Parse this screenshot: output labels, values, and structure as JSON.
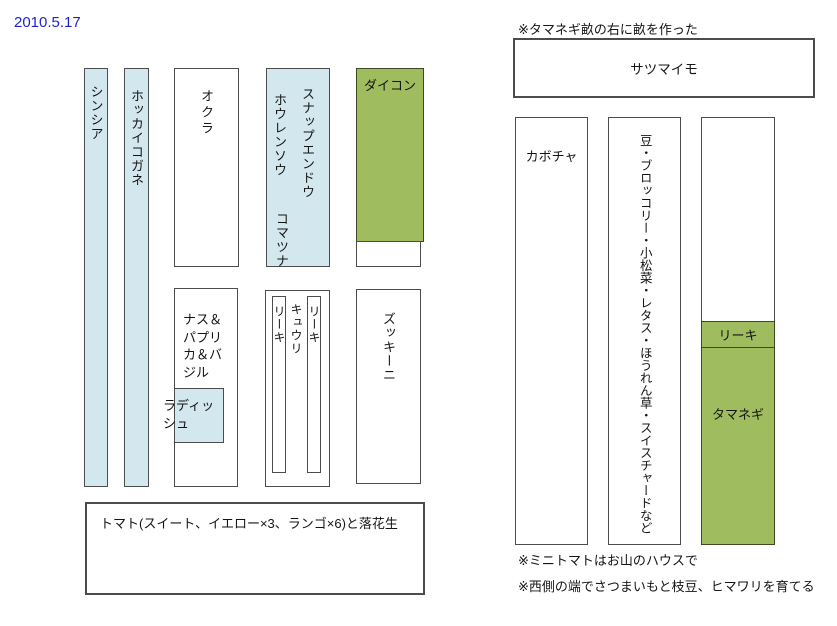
{
  "date": "2010.5.17",
  "colors": {
    "date_text": "#2222cc",
    "bed_lightblue": "#d3e7ee",
    "bed_green": "#9fbc5e",
    "border_dark": "#4c4c4c",
    "border_green": "#3e4a20"
  },
  "west_plot": {
    "shinshia": "シンシア",
    "hokkaikogane": "ホッカイコガネ",
    "okra": "オクラ",
    "snap_endou": "スナップエンドウ",
    "hourensou": "ホウレンソウ",
    "komatsuna": "コマツナ",
    "daikon": "ダイコン",
    "nasu_paprika_basil": "ナス＆パプリカ＆バジル",
    "radish": "ラディッシュ",
    "leek_left": "リーキ",
    "cucumber": "キュウリ",
    "leek_right": "リーキ",
    "zucchini": "ズッキーニ",
    "tomato": "トマト(スイート、イエロー×3、ランゴ×6)と落花生"
  },
  "east_plot": {
    "note_top": "※タマネギ畝の右に畝を作った",
    "satsumaimo": "サツマイモ",
    "kabocha": "カボチャ",
    "mixed_bed": "豆・ブロッコリー・小松菜・レタス・ほうれん草・スイスチャードなど",
    "leek": "リーキ",
    "tamanegi": "タマネギ",
    "note_mini_tomato": "※ミニトマトはお山のハウスで",
    "note_west_edge": "※西側の端でさつまいもと枝豆、ヒマワリを育てる"
  }
}
